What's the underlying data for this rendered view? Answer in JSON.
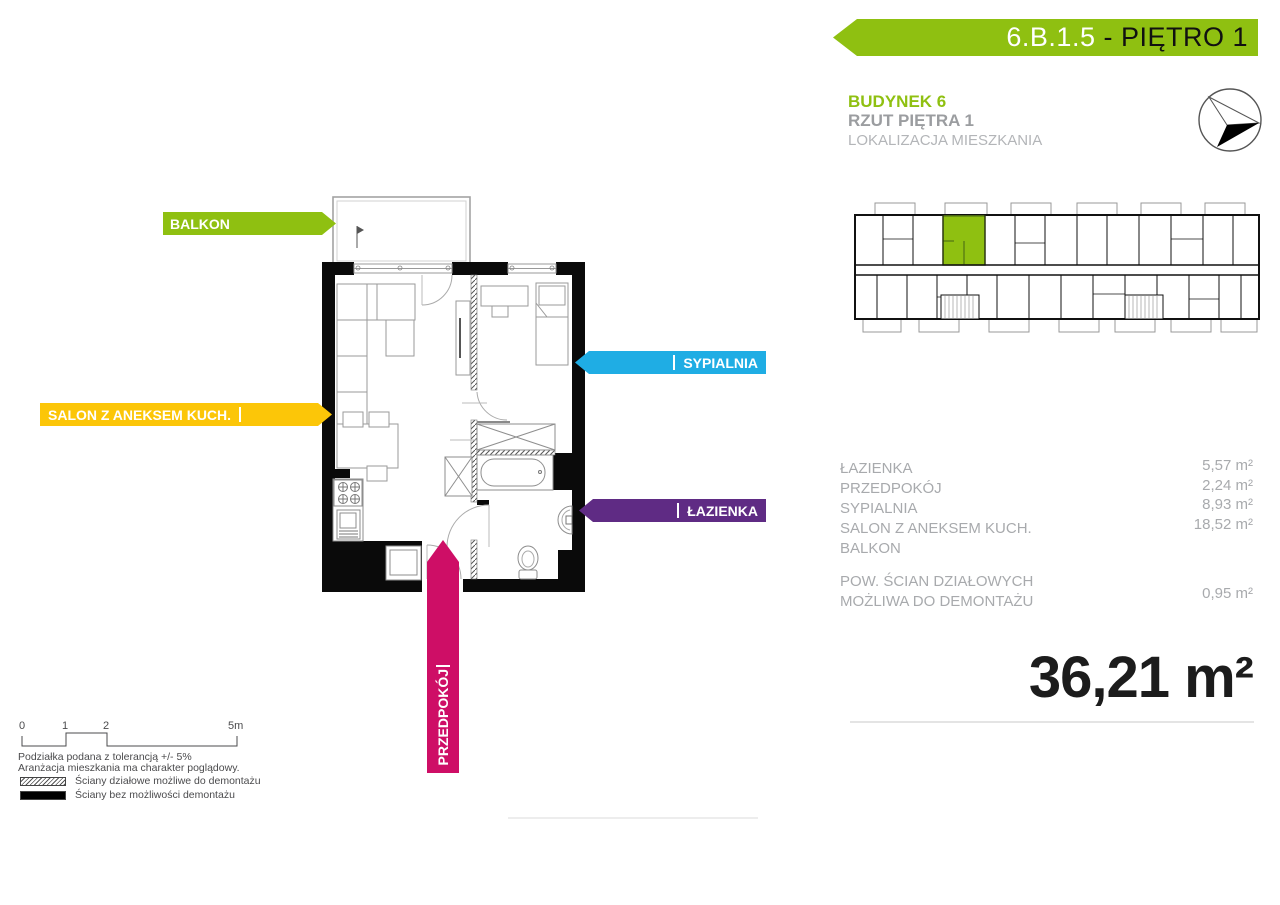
{
  "banner": {
    "unit_id": "6.B.1.5",
    "floor_suffix": " - PIĘTRO 1"
  },
  "header": {
    "building": "BUDYNEK 6",
    "floor_plan": "RZUT PIĘTRA 1",
    "location": "LOKALIZACJA MIESZKANIA"
  },
  "plan_labels": {
    "balkon": "BALKON",
    "sypialnia": "SYPIALNIA",
    "salon": "SALON Z ANEKSEM KUCH.",
    "lazienka": "ŁAZIENKA",
    "przedpokoj": "PRZEDPOKÓJ"
  },
  "rooms": [
    {
      "name": "ŁAZIENKA",
      "area": "5,57 m²"
    },
    {
      "name": "PRZEDPOKÓJ",
      "area": "2,24 m²"
    },
    {
      "name": "SYPIALNIA",
      "area": "8,93 m²"
    },
    {
      "name": "SALON Z ANEKSEM KUCH.",
      "area": "18,52 m²"
    },
    {
      "name": "BALKON",
      "area": ""
    }
  ],
  "partition_walls": {
    "line1": "POW. ŚCIAN DZIAŁOWYCH",
    "line2": "MOŻLIWA DO DEMONTAŻU",
    "area": "0,95 m²"
  },
  "total_area": "36,21 m²",
  "scale_bar": {
    "ticks": [
      "0",
      "1",
      "2",
      "5m"
    ],
    "note1": "Podziałka podana z tolerancją +/- 5%",
    "note2": "Aranżacja mieszkania ma charakter poglądowy.",
    "legend": [
      {
        "label": "Ściany działowe możliwe do demontażu"
      },
      {
        "label": "Ściany bez możliwości demontażu"
      }
    ]
  },
  "colors": {
    "green": "#8fc011",
    "blue": "#1fade4",
    "yellow": "#fcc608",
    "purple": "#5f2b84",
    "pink": "#ce0e66",
    "green_dark": "#5e8212"
  }
}
